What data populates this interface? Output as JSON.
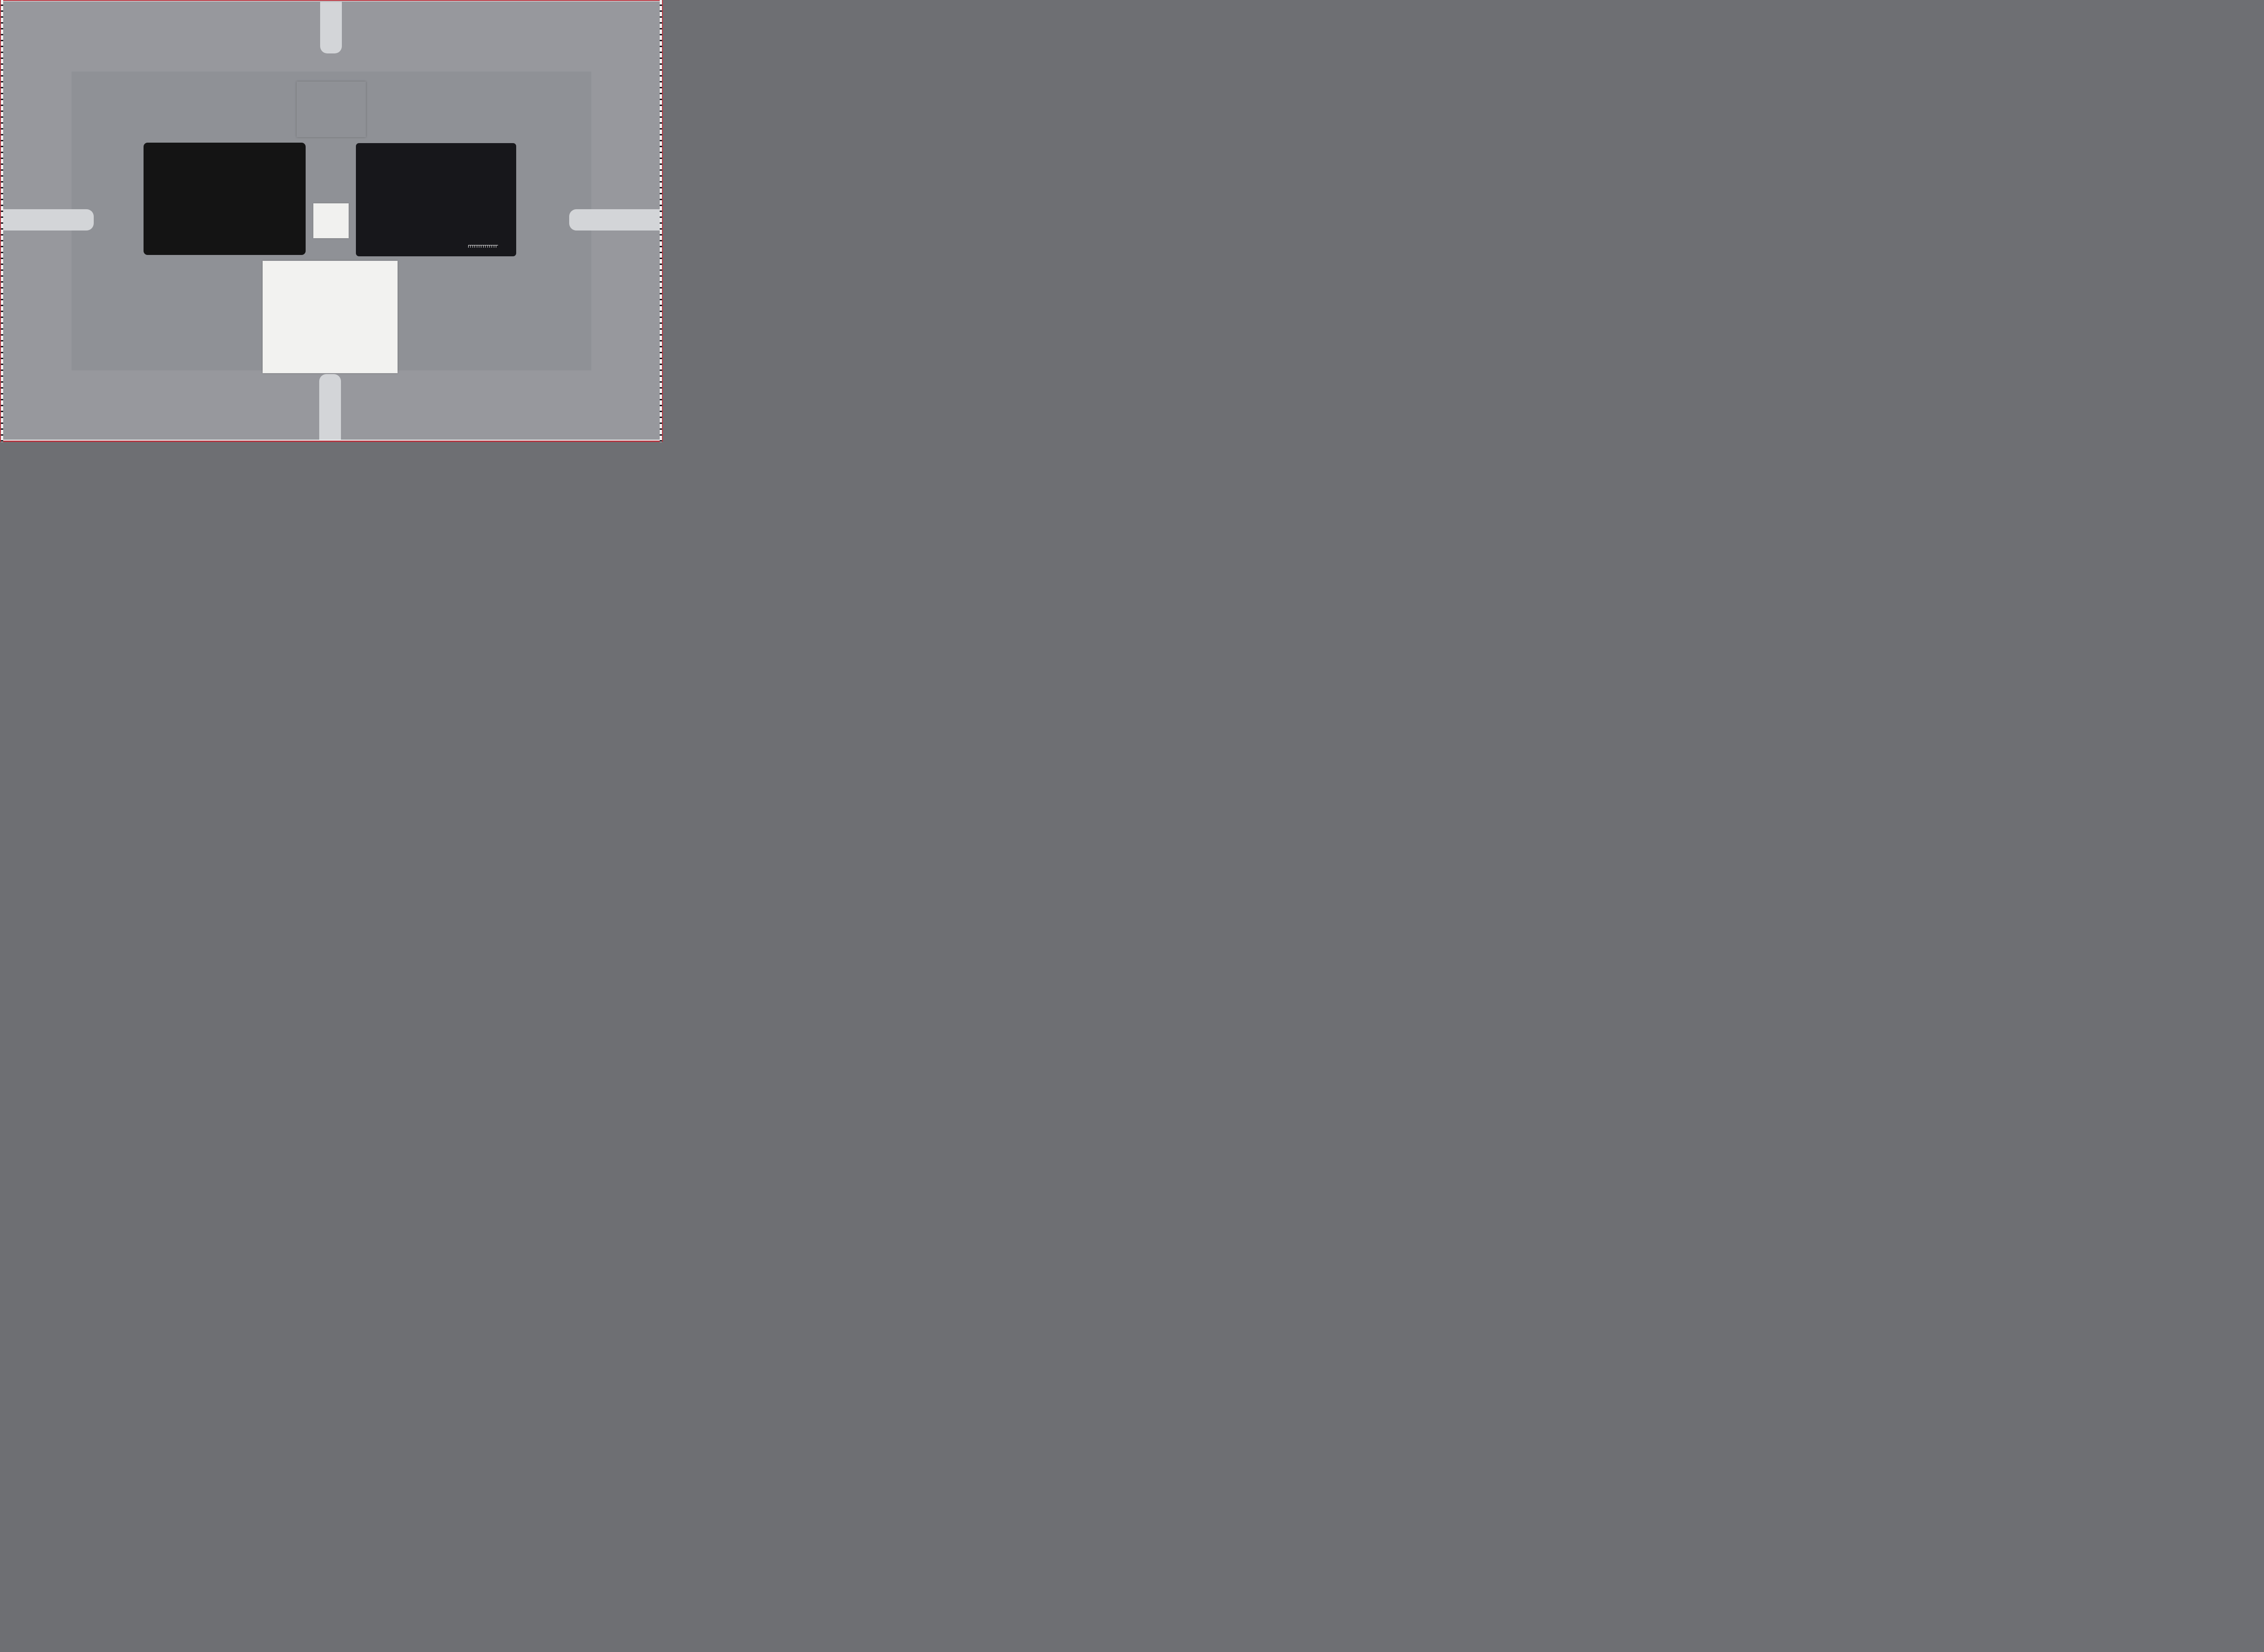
{
  "scene": "ISO 12233-style camera resolution and color test chart scene",
  "frame": {
    "background": "#97989d",
    "inner_background": "#8f9196",
    "line_color": "#23232e",
    "red_edge": "#b43540",
    "tab_color": "#d3d5d8"
  },
  "usaf": {
    "top": [
      "-2",
      "-1"
    ],
    "left": [
      "2",
      "3",
      "4",
      "5",
      "6"
    ],
    "right": [
      "1",
      "2",
      "3",
      "4",
      "5",
      "6"
    ],
    "corner": [
      "-2",
      "1"
    ],
    "micro": [
      "0",
      "1",
      "0",
      "1"
    ]
  },
  "colorchecker": {
    "brand": "x-rite",
    "logo_glyph": "✕",
    "label": "ColorChecker® Color Rendition Chart",
    "rows": 4,
    "cols": 6,
    "patches": [
      "#7a4b36",
      "#d9a087",
      "#5b84bc",
      "#4a5a25",
      "#a397d7",
      "#63d0c0",
      "#e88617",
      "#3f58c9",
      "#dd5a63",
      "#532a71",
      "#a3c82c",
      "#e2a71c",
      "#1431b5",
      "#27a339",
      "#cc2a26",
      "#e8cb18",
      "#df54ab",
      "#12a0cc",
      "#f4f4f1",
      "#e0e1e0",
      "#c3c6c6",
      "#84898a",
      "#4d5254",
      "#16191b"
    ]
  },
  "sg": {
    "title": "Digital ColorChecker® SG",
    "logo": "x-rite",
    "logo_glyph": "✕",
    "row_labels": [
      "1",
      "2",
      "3",
      "4",
      "5",
      "6",
      "7",
      "8",
      "9",
      "10"
    ],
    "col_labels": [
      "A",
      "B",
      "C",
      "D",
      "E",
      "F",
      "G",
      "H",
      "I",
      "J",
      "K",
      "L",
      "M",
      "N"
    ],
    "ruler_numbers": [
      "0",
      "1",
      "2",
      "3",
      "4",
      "5",
      "6"
    ],
    "ruler_unit": "mm",
    "patches": [
      [
        "#f0f0ec",
        "#8d8d8b",
        "#1d1d1d",
        "#f0f0ec",
        "#7d7d7b",
        "#1d1d1d",
        "#f0f0ec",
        "#8d8d8b",
        "#1d1d1d",
        "#f0f0ec",
        "#9b9b99",
        "#131313",
        "#4b4b4b",
        "#f0f0ec"
      ],
      [
        "#222222",
        "#ad2e62",
        "#3a2a52",
        "#d6dfe9",
        "#84502c",
        "#dfa07e",
        "#5b83bd",
        "#46511d",
        "#8b8fd2",
        "#5fc4bb",
        "#efd3b4",
        "#7e1e38",
        "#d62f66",
        "#7f7f7d"
      ],
      [
        "#7f7f7d",
        "#c791cf",
        "#8268bd",
        "#f1ccd8",
        "#db7318",
        "#304fc2",
        "#d94f51",
        "#3f2066",
        "#a0c428",
        "#d99c17",
        "#ccecdf",
        "#d62b20",
        "#64203f",
        "#1d1d1d"
      ],
      [
        "#f0f0ec",
        "#6f2590",
        "#173a5c",
        "#a8e0cd",
        "#1823af",
        "#1f9c38",
        "#cb2028",
        "#dcbd17",
        "#d552a8",
        "#1b8dc4",
        "#f0dbdf",
        "#e789a2",
        "#d81f38",
        "#7f7f7d"
      ],
      [
        "#222222",
        "#2a85d8",
        "#55a8d8",
        "#f0d5cd",
        "#f0f0ec",
        "#c0c0bd",
        "#a2a2a0",
        "#848482",
        "#5f5f5d",
        "#2e2e2c",
        "#c6e4ef",
        "#ee8e77",
        "#e5471f",
        "#7f7f7d"
      ],
      [
        "#7f7f7d",
        "#32b4d4",
        "#0d3346",
        "#d2e6ac",
        "#1a1a18",
        "#3f3f3d",
        "#565654",
        "#757573",
        "#aeaeac",
        "#e8e8e5",
        "#c4c4c1",
        "#e58318",
        "#ddb517",
        "#1d1d1d"
      ],
      [
        "#f0f0ec",
        "#15594f",
        "#74a0d8",
        "#d89150",
        "#ecc4a4",
        "#dea47e",
        "#a8713c",
        "#e0af8c",
        "#a8671f",
        "#ecc9a8",
        "#7f7f7d",
        "#b2bd17",
        "#dcbd17",
        "#f0f0ec"
      ],
      [
        "#222222",
        "#27b5a7",
        "#13998c",
        "#e8a988",
        "#f2bd9d",
        "#d69c74",
        "#e0a584",
        "#ecc19d",
        "#8c5a20",
        "#eed3b4",
        "#2a2a28",
        "#a98c14",
        "#93c226",
        "#7f7f7d"
      ],
      [
        "#7f7f7d",
        "#26230d",
        "#4fc287",
        "#1d9478",
        "#0c5243",
        "#2fbf95",
        "#8cd49e",
        "#2cae46",
        "#22b02c",
        "#c79a2c",
        "#9aa31e",
        "#83c81a",
        "#4c2013",
        "#1d1d1d"
      ],
      [
        "#f0f0ec",
        "#8d8d8b",
        "#1d1d1d",
        "#f0f0ec",
        "#7d7d7b",
        "#1d1d1d",
        "#f0f0ec",
        "#8d8d8b",
        "#1d1d1d",
        "#f0f0ec",
        "#9b9b99",
        "#131313",
        "#4b4b4b",
        "#f0f0ec"
      ]
    ]
  },
  "stars": [
    {
      "name": "red",
      "a": "#d93a24",
      "b": "#43100e",
      "center": "#7a2018"
    },
    {
      "name": "green",
      "a": "#3bcb6c",
      "b": "#0d2b12",
      "center": "#1d6b35"
    },
    {
      "name": "gold",
      "a": "#d85428",
      "b": "#7ec862",
      "center": "#b07030"
    },
    {
      "name": "blue",
      "a": "#3a62d8",
      "b": "#11142f",
      "center": "#22317e"
    },
    {
      "name": "teal",
      "a": "#4ecb8c",
      "b": "#2463c8",
      "center": "#3a96aa"
    },
    {
      "name": "magenta",
      "a": "#e04a5a",
      "b": "#4a55d8",
      "center": "#8f4f94"
    }
  ],
  "wedge": {
    "bar_color": "#17171d",
    "line_color": "#60606a",
    "ramp": [
      "#f2f1ef",
      "#eceae8",
      "#e6e4e2",
      "#dedcda",
      "#d6d4d2",
      "#ceccca",
      "#c6c4c2",
      "#bebcba",
      "#b6b3b1",
      "#aeaba9",
      "#a6a2a0",
      "#9d9997",
      "#948f8d",
      "#8b8684",
      "#827c7a",
      "#787270",
      "#6e6765",
      "#635c5a",
      "#575150",
      "#4b4644"
    ],
    "ramp_end_blocks": "#161413"
  },
  "portrait": {
    "bg1": "#2c3854",
    "bg2": "#1f2b46",
    "bg3": "#3c4a6e",
    "dress_yellow": "#e9d07c",
    "vest_red": "#7c2332",
    "skin_light": "#eec3a2",
    "hair_blonde": "#d8b264",
    "flower_pink": "#d87a92",
    "flower_white": "#e8e2d4",
    "kimono_blue": "#2c58c8",
    "hair_black": "#16161e",
    "skin_tan": "#e6bb96",
    "violin_brown": "#96481e",
    "coat_blue": "#1e4a6c",
    "skin_dark": "#7c4b31",
    "turban_yellow": "#e6c133",
    "turban_orange": "#c8742a",
    "bead_gold": "#e2bc26",
    "cello_brown": "#b06c2a"
  }
}
